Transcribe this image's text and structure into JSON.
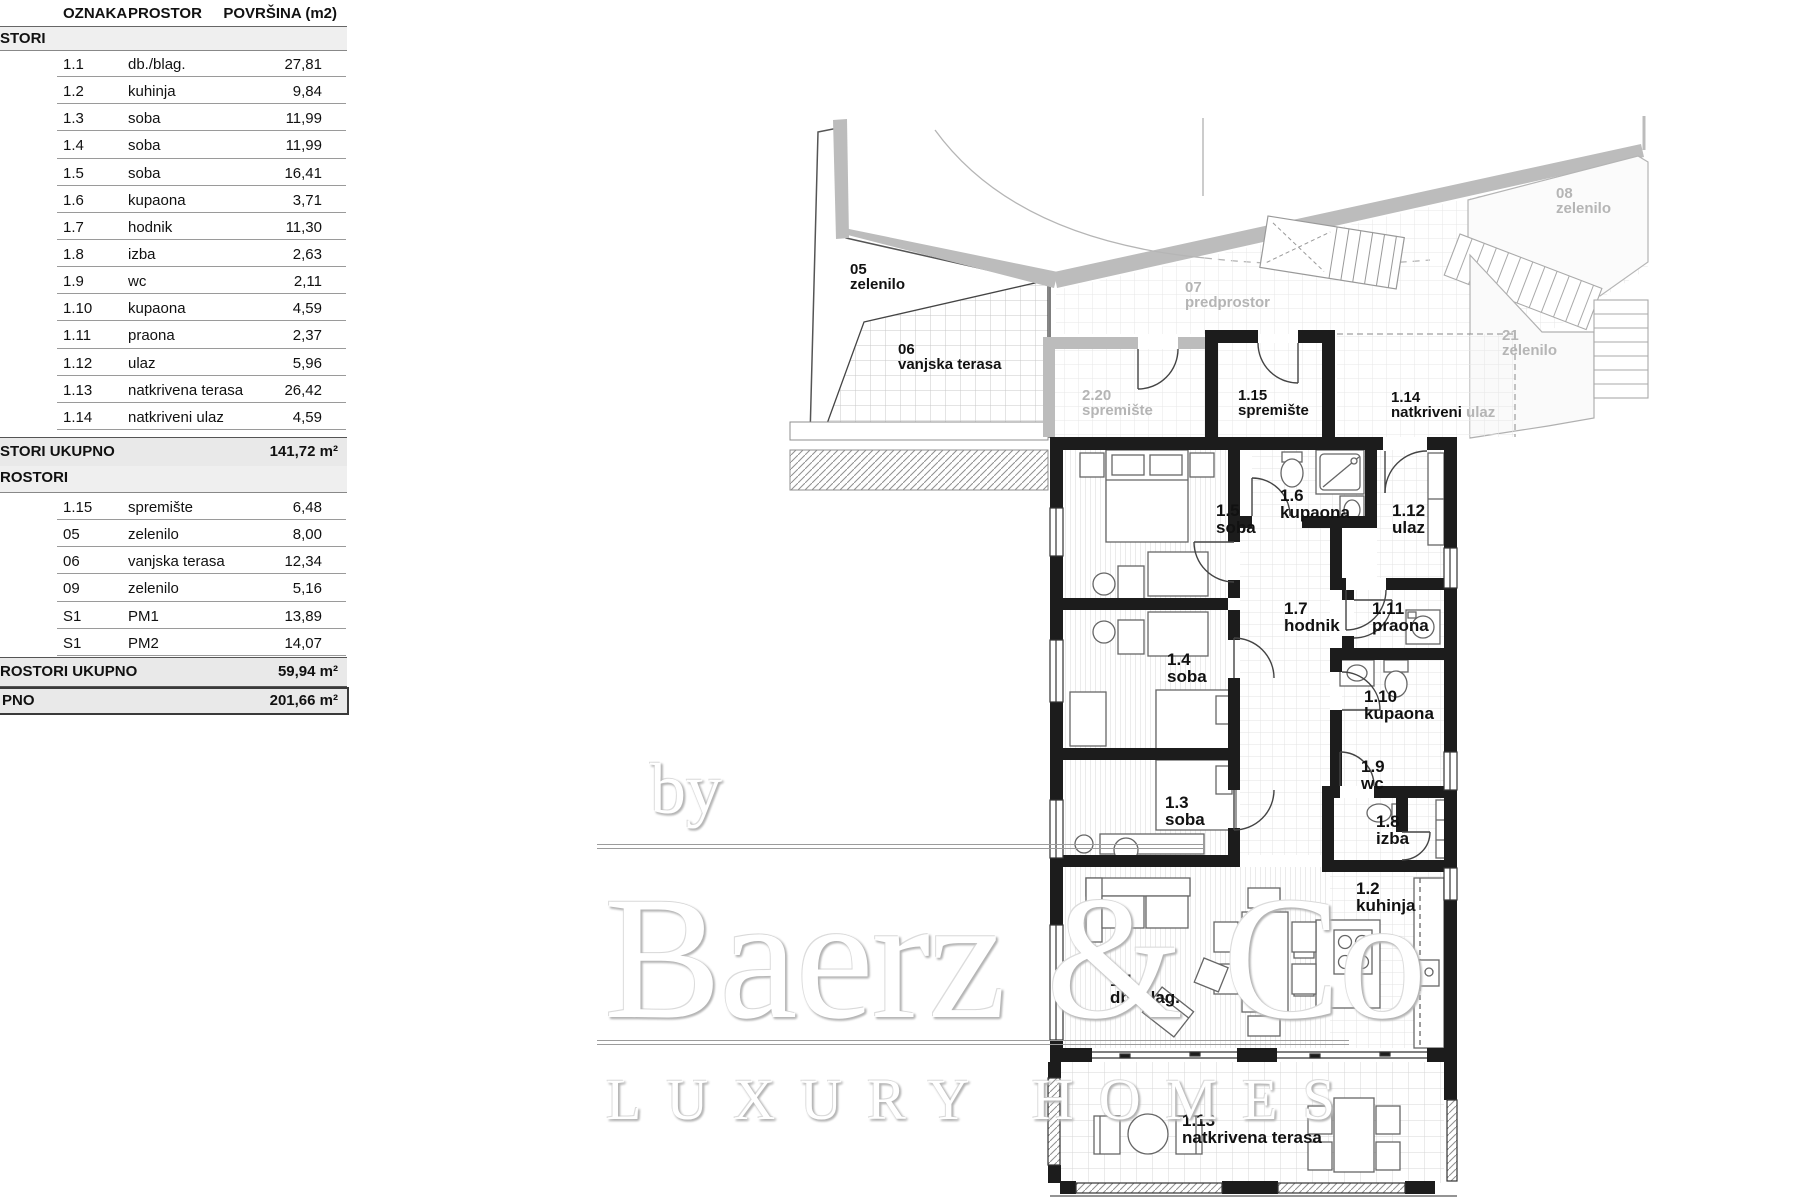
{
  "table": {
    "headers": {
      "col1": "OZNAKA",
      "col2": "PROSTOR",
      "col3": "POVRŠINA (m2)"
    },
    "section1": {
      "title": "STORI",
      "rows": [
        {
          "code": "1.1",
          "name": "db./blag.",
          "area": "27,81"
        },
        {
          "code": "1.2",
          "name": "kuhinja",
          "area": "9,84"
        },
        {
          "code": "1.3",
          "name": "soba",
          "area": "11,99"
        },
        {
          "code": "1.4",
          "name": "soba",
          "area": "11,99"
        },
        {
          "code": "1.5",
          "name": "soba",
          "area": "16,41"
        },
        {
          "code": "1.6",
          "name": "kupaona",
          "area": "3,71"
        },
        {
          "code": "1.7",
          "name": "hodnik",
          "area": "11,30"
        },
        {
          "code": "1.8",
          "name": "izba",
          "area": "2,63"
        },
        {
          "code": "1.9",
          "name": "wc",
          "area": "2,11"
        },
        {
          "code": "1.10",
          "name": "kupaona",
          "area": "4,59"
        },
        {
          "code": "1.11",
          "name": "praona",
          "area": "2,37"
        },
        {
          "code": "1.12",
          "name": "ulaz",
          "area": "5,96"
        },
        {
          "code": "1.13",
          "name": "natkrivena terasa",
          "area": "26,42"
        },
        {
          "code": "1.14",
          "name": "natkriveni ulaz",
          "area": "4,59"
        }
      ],
      "total_label": "STORI UKUPNO",
      "total_value": "141,72 m²"
    },
    "section2": {
      "title": "ROSTORI",
      "rows": [
        {
          "code": "1.15",
          "name": "spremište",
          "area": "6,48"
        },
        {
          "code": "05",
          "name": "zelenilo",
          "area": "8,00"
        },
        {
          "code": "06",
          "name": "vanjska terasa",
          "area": "12,34"
        },
        {
          "code": "09",
          "name": "zelenilo",
          "area": "5,16"
        },
        {
          "code": "S1",
          "name": "PM1",
          "area": "13,89"
        },
        {
          "code": "S1",
          "name": "PM2",
          "area": "14,07"
        }
      ],
      "total_label": "ROSTORI UKUPNO",
      "total_value": "59,94 m²"
    },
    "grand": {
      "label": "PNO",
      "value": "201,66 m²"
    }
  },
  "plan": {
    "labels": {
      "z05": {
        "code": "05",
        "name": "zelenilo"
      },
      "z06": {
        "code": "06",
        "name": "vanjska terasa"
      },
      "s220": {
        "code": "2.20",
        "name": "spremište"
      },
      "s115": {
        "code": "1.15",
        "name": "spremište"
      },
      "u114": {
        "code": "1.14",
        "name": "natkriveni",
        "suffix": " ulaz"
      },
      "p07": {
        "code": "07",
        "name": "predprostor"
      },
      "z08": {
        "code": "08",
        "name": "zelenilo"
      },
      "z21": {
        "code": "21",
        "name": "zelenilo"
      },
      "r11": {
        "code": "1.1",
        "name": "db./blag."
      },
      "r12": {
        "code": "1.2",
        "name": "kuhinja"
      },
      "r13": {
        "code": "1.3",
        "name": "soba"
      },
      "r14": {
        "code": "1.4",
        "name": "soba"
      },
      "r15": {
        "code": "1.5",
        "name": "soba"
      },
      "r16": {
        "code": "1.6",
        "name": "kupaona"
      },
      "r17": {
        "code": "1.7",
        "name": "hodnik"
      },
      "r18": {
        "code": "1.8",
        "name": "izba"
      },
      "r19": {
        "code": "1.9",
        "name": "wc"
      },
      "r110": {
        "code": "1.10",
        "name": "kupaona"
      },
      "r111": {
        "code": "1.11",
        "name": "praona"
      },
      "r112": {
        "code": "1.12",
        "name": "ulaz"
      },
      "r113": {
        "code": "1.13",
        "name": "natkrivena terasa"
      }
    }
  },
  "watermark": {
    "by": "by",
    "brand": "Baerz & Co",
    "tagline": "LUXURY HOMES"
  },
  "colors": {
    "wall": "#1c1c1c",
    "context_gray": "#bcbcbc",
    "context_text": "#b5b5b5"
  }
}
